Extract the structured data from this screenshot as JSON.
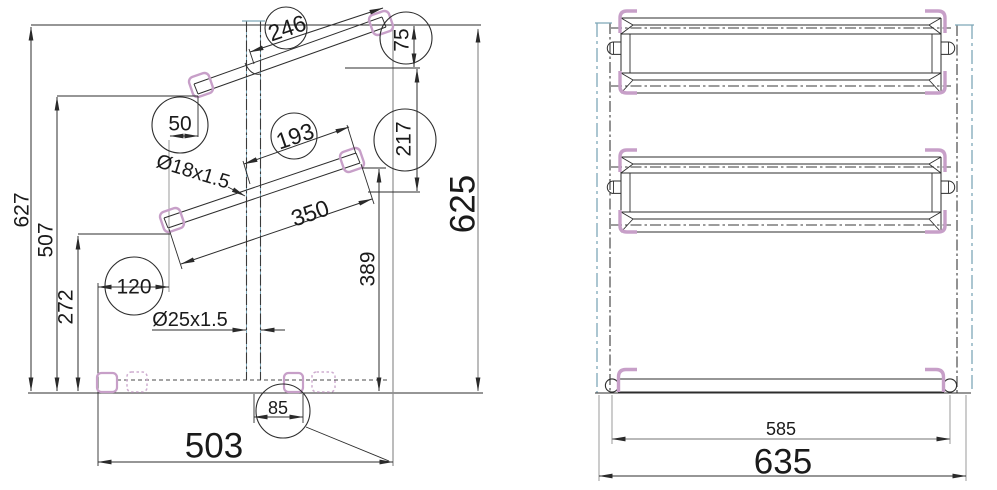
{
  "drawing": {
    "type": "technical-cad-drawing",
    "colors": {
      "background": "#ffffff",
      "main_line": "#2d2d2d",
      "extension_gray": "#909090",
      "phantom_teal": "#7ea7b8",
      "phantom_dark": "#3a3a3a",
      "bracket_pink": "#c79fc8",
      "hidden_dash": "#4a4a4a",
      "text": "#1a1a1a"
    }
  },
  "side_view": {
    "labels": {
      "d627": "627",
      "d507": "507",
      "d272": "272",
      "d120": "120",
      "d50": "50",
      "d246": "246",
      "d75": "75",
      "d193": "193",
      "d217": "217",
      "d350": "350",
      "d389": "389",
      "d85": "85",
      "d503": "503",
      "d625": "625",
      "tube18": "Ø18x1.5",
      "tube25": "Ø25x1.5"
    }
  },
  "front_view": {
    "labels": {
      "d585": "585",
      "d635": "635"
    }
  }
}
